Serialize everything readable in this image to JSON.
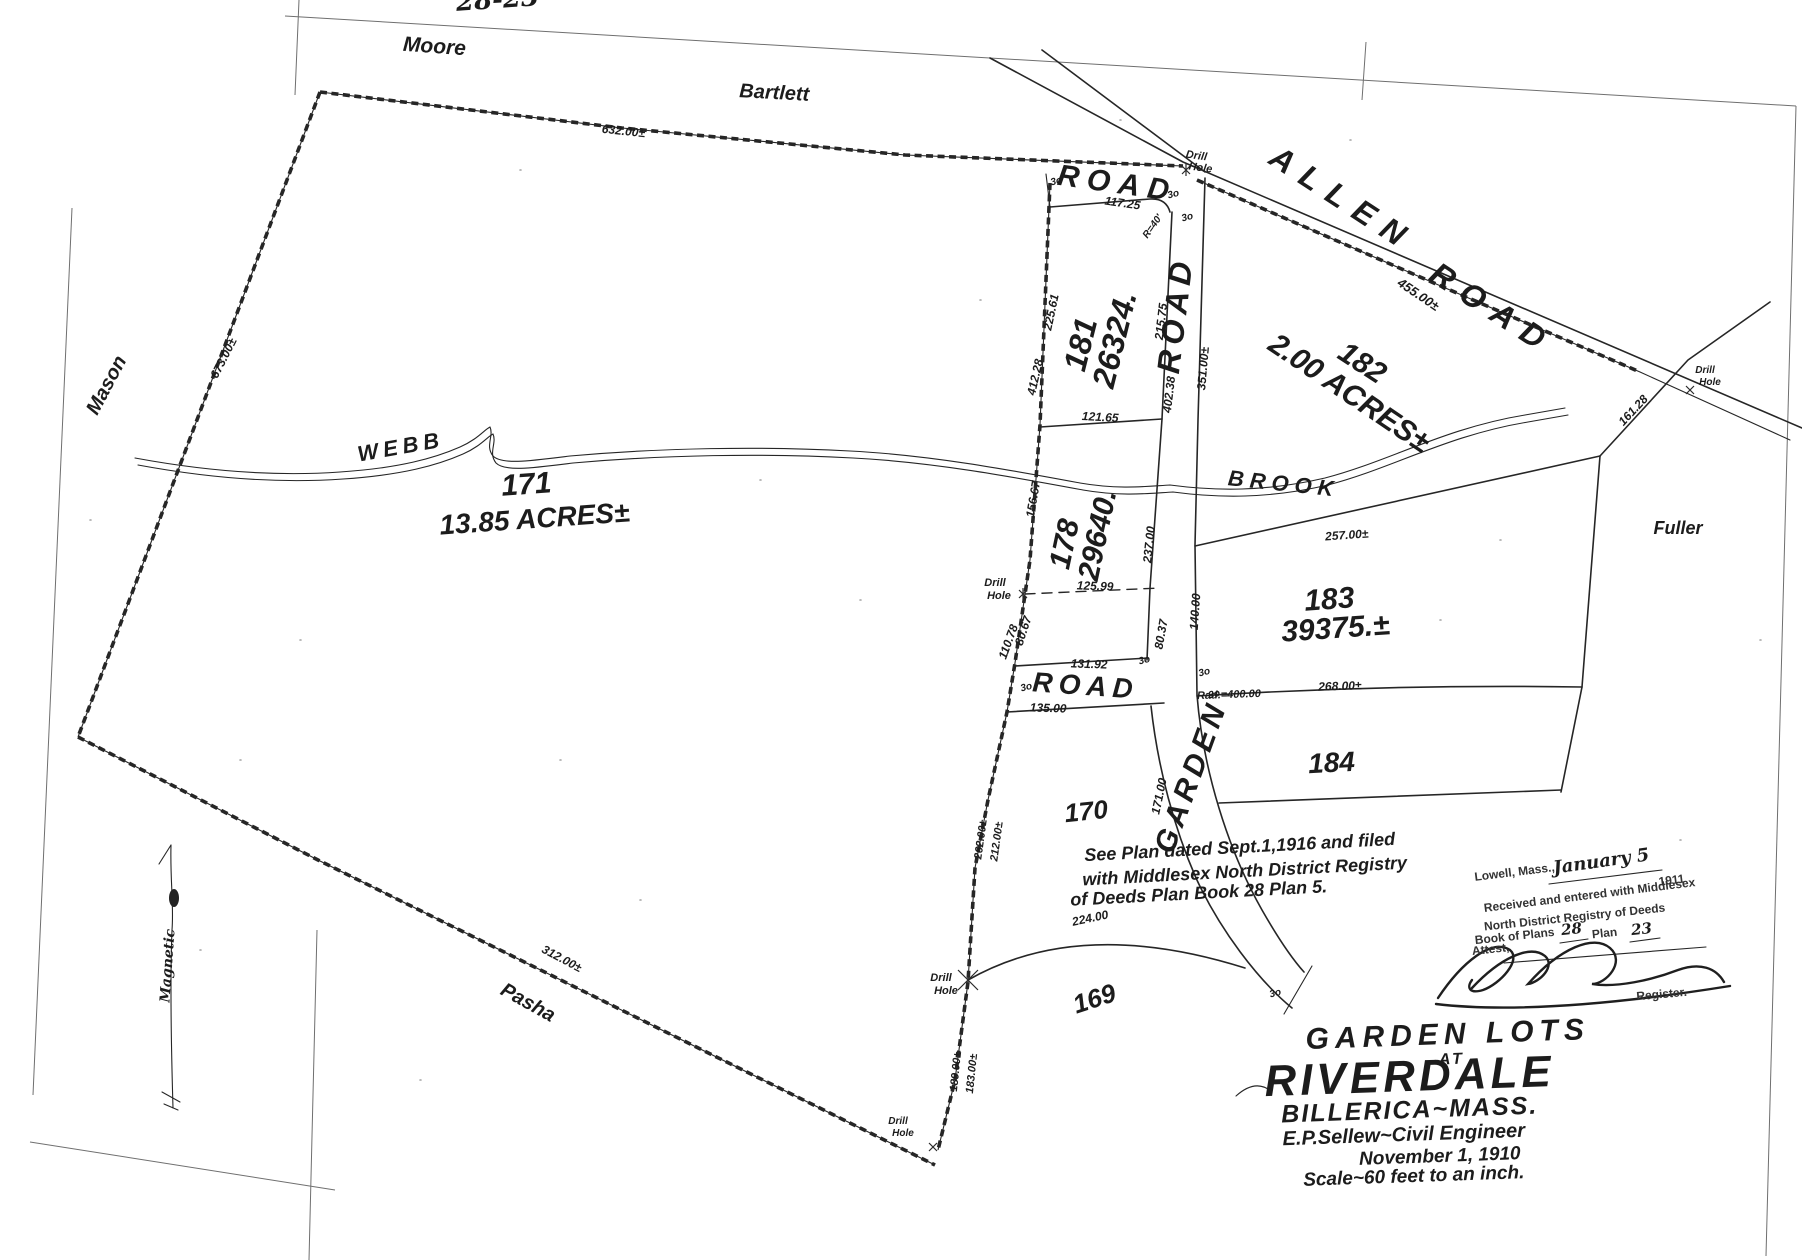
{
  "summary": {
    "plan_title": "Garden Lots at Riverdale, Billerica, Mass.",
    "engineer": "E.P.Sellew~Civil Engineer",
    "date": "November 1, 1910",
    "scale": "Scale~60 feet to an inch.",
    "lots": [
      {
        "number": "171",
        "area": "13.85 ACRES±"
      },
      {
        "number": "181",
        "area": "26324."
      },
      {
        "number": "182",
        "area": "2.00 ACRES±"
      },
      {
        "number": "178",
        "area": "29640."
      },
      {
        "number": "183",
        "area": "39375.±"
      },
      {
        "number": "184",
        "area": ""
      },
      {
        "number": "170",
        "area": ""
      },
      {
        "number": "169",
        "area": ""
      }
    ],
    "roads": [
      "ALLEN ROAD",
      "GARDEN ROAD",
      "ROAD"
    ],
    "abutters": [
      "Moore",
      "Bartlett",
      "Mason",
      "Pasha",
      "Fuller"
    ],
    "watercourse": "WEBB BROOK",
    "page_ref": "28-23"
  },
  "labels": [
    {
      "n": "page-ref",
      "t": "28-23",
      "x": 498,
      "y": 8,
      "r": -4,
      "s": 26,
      "c": "cursive"
    },
    {
      "n": "road-label-bartlett-segment",
      "t": "ROAD",
      "x": 1116,
      "y": 193,
      "r": 8,
      "s": 30,
      "sp": 8,
      "c": "hand"
    },
    {
      "n": "allen-road-label-allen",
      "t": "ALLEN",
      "x": 1337,
      "y": 208,
      "r": 33,
      "s": 32,
      "sp": 12,
      "c": "hand"
    },
    {
      "n": "allen-road-label-road",
      "t": "ROAD",
      "x": 1487,
      "y": 318,
      "r": 33,
      "s": 32,
      "sp": 12,
      "c": "hand"
    },
    {
      "n": "garden-road-label-road",
      "t": "ROAD",
      "x": 1186,
      "y": 316,
      "r": -83,
      "s": 32,
      "sp": 6,
      "c": "hand"
    },
    {
      "n": "garden-road-label-garden",
      "t": "GARDEN",
      "x": 1200,
      "y": 780,
      "r": -70,
      "s": 30,
      "sp": 5,
      "c": "hand"
    },
    {
      "n": "access-road-label",
      "t": "ROAD",
      "x": 1085,
      "y": 695,
      "r": 4,
      "s": 28,
      "sp": 6,
      "c": "hand"
    },
    {
      "n": "abutter-moore",
      "t": "Moore",
      "x": 434,
      "y": 53,
      "r": 4,
      "s": 21,
      "c": "hand"
    },
    {
      "n": "abutter-bartlett",
      "t": "Bartlett",
      "x": 774,
      "y": 99,
      "r": 3,
      "s": 20,
      "c": "hand"
    },
    {
      "n": "abutter-mason",
      "t": "Mason",
      "x": 112,
      "y": 388,
      "r": -62,
      "s": 20,
      "c": "hand"
    },
    {
      "n": "abutter-pasha",
      "t": "Pasha",
      "x": 525,
      "y": 1008,
      "r": 29,
      "s": 20,
      "c": "hand"
    },
    {
      "n": "abutter-fuller",
      "t": "Fuller",
      "x": 1678,
      "y": 534,
      "r": 0,
      "s": 18,
      "c": "hand"
    },
    {
      "n": "webb-brook-label-webb",
      "t": "WEBB",
      "x": 402,
      "y": 454,
      "r": -10,
      "s": 22,
      "sp": 5,
      "c": "hand"
    },
    {
      "n": "webb-brook-label-brook",
      "t": "BROOK",
      "x": 1283,
      "y": 491,
      "r": 6,
      "s": 22,
      "sp": 6,
      "c": "hand"
    },
    {
      "n": "magnetic-north-label",
      "t": "Magnetic",
      "x": 172,
      "y": 966,
      "r": -86,
      "s": 14,
      "c": "cursive"
    },
    {
      "n": "lot-171-number",
      "t": "171",
      "x": 527,
      "y": 494,
      "r": -4,
      "s": 30,
      "c": "hand"
    },
    {
      "n": "lot-171-area",
      "t": "13.85 ACRES±",
      "x": 535,
      "y": 528,
      "r": -4,
      "s": 28,
      "c": "hand"
    },
    {
      "n": "lot-181-number",
      "t": "181",
      "x": 1091,
      "y": 347,
      "r": -76,
      "s": 32,
      "c": "hand"
    },
    {
      "n": "lot-181-area",
      "t": "26324.",
      "x": 1125,
      "y": 342,
      "r": -76,
      "s": 32,
      "c": "hand"
    },
    {
      "n": "lot-182-number",
      "t": "182",
      "x": 1357,
      "y": 371,
      "r": 33,
      "s": 30,
      "c": "hand"
    },
    {
      "n": "lot-182-area",
      "t": "2.00 ACRES±",
      "x": 1344,
      "y": 401,
      "r": 34,
      "s": 30,
      "c": "hand"
    },
    {
      "n": "lot-178-number",
      "t": "178",
      "x": 1074,
      "y": 546,
      "r": -78,
      "s": 30,
      "c": "hand"
    },
    {
      "n": "lot-178-area",
      "t": "29640.",
      "x": 1107,
      "y": 537,
      "r": -78,
      "s": 30,
      "c": "hand"
    },
    {
      "n": "lot-183-number",
      "t": "183",
      "x": 1330,
      "y": 609,
      "r": -4,
      "s": 30,
      "c": "hand"
    },
    {
      "n": "lot-183-area",
      "t": "39375.±",
      "x": 1336,
      "y": 638,
      "r": -4,
      "s": 30,
      "c": "hand"
    },
    {
      "n": "lot-184-number",
      "t": "184",
      "x": 1332,
      "y": 772,
      "r": -3,
      "s": 28,
      "c": "hand"
    },
    {
      "n": "lot-170-number",
      "t": "170",
      "x": 1087,
      "y": 820,
      "r": -6,
      "s": 26,
      "c": "hand"
    },
    {
      "n": "lot-169-number",
      "t": "169",
      "x": 1097,
      "y": 1007,
      "r": -18,
      "s": 26,
      "c": "hand"
    },
    {
      "n": "dim-632",
      "t": "632.00±",
      "x": 623,
      "y": 135,
      "r": 6,
      "s": 12,
      "c": "hand"
    },
    {
      "n": "dim-673",
      "t": "673.00±",
      "x": 227,
      "y": 360,
      "r": -63,
      "s": 12,
      "c": "hand"
    },
    {
      "n": "dim-455",
      "t": "455.00±",
      "x": 1416,
      "y": 298,
      "r": 34,
      "s": 13,
      "c": "hand"
    },
    {
      "n": "dim-117-25",
      "t": "117.25",
      "x": 1122,
      "y": 207,
      "r": 8,
      "s": 12,
      "c": "hand"
    },
    {
      "n": "dim-225-61",
      "t": "225.61",
      "x": 1055,
      "y": 313,
      "r": -78,
      "s": 12,
      "c": "hand"
    },
    {
      "n": "dim-412-28",
      "t": "412.28",
      "x": 1039,
      "y": 378,
      "r": -77,
      "s": 12,
      "c": "hand"
    },
    {
      "n": "dim-215-75",
      "t": "215.75",
      "x": 1165,
      "y": 322,
      "r": -83,
      "s": 12,
      "c": "hand"
    },
    {
      "n": "dim-402-38",
      "t": "402.38",
      "x": 1173,
      "y": 395,
      "r": -83,
      "s": 12,
      "c": "hand"
    },
    {
      "n": "dim-351",
      "t": "351.00±",
      "x": 1207,
      "y": 369,
      "r": -85,
      "s": 12,
      "c": "hand"
    },
    {
      "n": "dim-121-65",
      "t": "121.65",
      "x": 1100,
      "y": 421,
      "r": 3,
      "s": 12,
      "c": "hand"
    },
    {
      "n": "dim-156-67",
      "t": "156.67",
      "x": 1037,
      "y": 500,
      "r": -80,
      "s": 12,
      "c": "hand"
    },
    {
      "n": "dim-237",
      "t": "237.00",
      "x": 1153,
      "y": 545,
      "r": -84,
      "s": 12,
      "c": "hand"
    },
    {
      "n": "dim-125-99",
      "t": "125.99",
      "x": 1095,
      "y": 590,
      "r": 2,
      "s": 12,
      "c": "hand"
    },
    {
      "n": "dim-110-78",
      "t": "110.78",
      "x": 1012,
      "y": 643,
      "r": -70,
      "s": 12,
      "c": "hand"
    },
    {
      "n": "dim-80-67",
      "t": "80.67",
      "x": 1027,
      "y": 632,
      "r": -72,
      "s": 12,
      "c": "hand"
    },
    {
      "n": "dim-80-37",
      "t": "80.37",
      "x": 1165,
      "y": 635,
      "r": -80,
      "s": 12,
      "c": "hand"
    },
    {
      "n": "dim-131-92",
      "t": "131.92",
      "x": 1089,
      "y": 668,
      "r": 2,
      "s": 12,
      "c": "hand"
    },
    {
      "n": "dim-135",
      "t": "135.00",
      "x": 1048,
      "y": 712,
      "r": 2,
      "s": 12,
      "c": "hand"
    },
    {
      "n": "dim-257",
      "t": "257.00±",
      "x": 1347,
      "y": 539,
      "r": -4,
      "s": 12,
      "c": "hand"
    },
    {
      "n": "dim-140",
      "t": "140.00",
      "x": 1199,
      "y": 612,
      "r": -86,
      "s": 12,
      "c": "hand"
    },
    {
      "n": "dim-268",
      "t": "268.00±",
      "x": 1340,
      "y": 690,
      "r": -2,
      "s": 12,
      "c": "hand"
    },
    {
      "n": "dim-rad-400",
      "t": "Rad.=400.00",
      "x": 1229,
      "y": 698,
      "r": -2,
      "s": 11,
      "c": "hand"
    },
    {
      "n": "dim-171",
      "t": "171.00",
      "x": 1163,
      "y": 797,
      "r": -78,
      "s": 12,
      "c": "hand"
    },
    {
      "n": "dim-262",
      "t": "262.00±",
      "x": 984,
      "y": 840,
      "r": -82,
      "s": 11,
      "c": "hand"
    },
    {
      "n": "dim-212",
      "t": "212.00±",
      "x": 1000,
      "y": 842,
      "r": -82,
      "s": 11,
      "c": "hand"
    },
    {
      "n": "dim-224",
      "t": "224.00",
      "x": 1091,
      "y": 922,
      "r": -12,
      "s": 12,
      "c": "hand"
    },
    {
      "n": "dim-189",
      "t": "189.00±",
      "x": 959,
      "y": 1072,
      "r": -84,
      "s": 11,
      "c": "hand"
    },
    {
      "n": "dim-183",
      "t": "183.00±",
      "x": 975,
      "y": 1074,
      "r": -84,
      "s": 11,
      "c": "hand"
    },
    {
      "n": "dim-312",
      "t": "312.00±",
      "x": 560,
      "y": 962,
      "r": 28,
      "s": 12,
      "c": "hand"
    },
    {
      "n": "dim-161-28",
      "t": "161.28",
      "x": 1636,
      "y": 413,
      "r": -47,
      "s": 12,
      "c": "hand"
    },
    {
      "n": "dim-r40",
      "t": "R=40'",
      "x": 1155,
      "y": 228,
      "r": -55,
      "s": 10,
      "c": "hand"
    },
    {
      "n": "drill-hole-1-line1",
      "t": "Drill",
      "x": 1196,
      "y": 159,
      "r": 8,
      "s": 11,
      "c": "hand"
    },
    {
      "n": "drill-hole-1-line2",
      "t": "Hole",
      "x": 1200,
      "y": 171,
      "r": 8,
      "s": 11,
      "c": "hand"
    },
    {
      "n": "drill-hole-2-line1",
      "t": "Drill",
      "x": 995,
      "y": 586,
      "r": 0,
      "s": 11,
      "c": "hand"
    },
    {
      "n": "drill-hole-2-line2",
      "t": "Hole",
      "x": 999,
      "y": 599,
      "r": 0,
      "s": 11,
      "c": "hand"
    },
    {
      "n": "drill-hole-3-line1",
      "t": "Drill",
      "x": 941,
      "y": 981,
      "r": 0,
      "s": 11,
      "c": "hand"
    },
    {
      "n": "drill-hole-3-line2",
      "t": "Hole",
      "x": 946,
      "y": 994,
      "r": 0,
      "s": 11,
      "c": "hand"
    },
    {
      "n": "drill-hole-4-line1",
      "t": "Drill",
      "x": 1705,
      "y": 373,
      "r": 0,
      "s": 10,
      "c": "hand"
    },
    {
      "n": "drill-hole-4-line2",
      "t": "Hole",
      "x": 1710,
      "y": 385,
      "r": 0,
      "s": 10,
      "c": "hand"
    },
    {
      "n": "drill-hole-5-line1",
      "t": "Drill",
      "x": 898,
      "y": 1124,
      "r": 0,
      "s": 10,
      "c": "hand"
    },
    {
      "n": "drill-hole-5-line2",
      "t": "Hole",
      "x": 903,
      "y": 1136,
      "r": 0,
      "s": 10,
      "c": "hand"
    },
    {
      "n": "road-width-mark-1",
      "t": "3o",
      "x": 1057,
      "y": 184,
      "r": -15,
      "s": 10,
      "c": "hand"
    },
    {
      "n": "road-width-mark-2",
      "t": "3o",
      "x": 1174,
      "y": 197,
      "r": -15,
      "s": 10,
      "c": "hand"
    },
    {
      "n": "road-width-mark-3",
      "t": "3o",
      "x": 1188,
      "y": 220,
      "r": -15,
      "s": 10,
      "c": "hand"
    },
    {
      "n": "road-width-mark-4",
      "t": "3o",
      "x": 1027,
      "y": 690,
      "r": -15,
      "s": 10,
      "c": "hand"
    },
    {
      "n": "road-width-mark-5",
      "t": "3o",
      "x": 1145,
      "y": 663,
      "r": -15,
      "s": 10,
      "c": "hand"
    },
    {
      "n": "road-width-mark-6",
      "t": "3o",
      "x": 1205,
      "y": 675,
      "r": -15,
      "s": 10,
      "c": "hand"
    },
    {
      "n": "road-width-mark-7",
      "t": "3o",
      "x": 1215,
      "y": 697,
      "r": -15,
      "s": 10,
      "c": "hand"
    },
    {
      "n": "road-width-mark-8",
      "t": "3o",
      "x": 1276,
      "y": 996,
      "r": -15,
      "s": 10,
      "c": "hand"
    },
    {
      "n": "plan-note-line1",
      "t": "See Plan dated Sept.1,1916 and filed",
      "x": 1240,
      "y": 853,
      "r": -3,
      "s": 18,
      "c": "hand"
    },
    {
      "n": "plan-note-line2",
      "t": "with Middlesex North District Registry",
      "x": 1245,
      "y": 877,
      "r": -3,
      "s": 18,
      "c": "hand"
    },
    {
      "n": "plan-note-line3",
      "t": "of Deeds Plan Book 28 Plan 5.",
      "x": 1199,
      "y": 899,
      "r": -3,
      "s": 18,
      "c": "hand"
    },
    {
      "n": "title-line1",
      "t": "GARDEN LOTS",
      "x": 1448,
      "y": 1044,
      "r": -2,
      "s": 30,
      "sp": 6,
      "c": "title"
    },
    {
      "n": "title-line2",
      "t": "AT",
      "x": 1452,
      "y": 1064,
      "r": -2,
      "s": 16,
      "sp": 3,
      "c": "title"
    },
    {
      "n": "title-line3",
      "t": "RIVERDALE",
      "x": 1410,
      "y": 1091,
      "r": -2,
      "s": 44,
      "sp": 4,
      "c": "title"
    },
    {
      "n": "title-line4",
      "t": "BILLERICA~MASS.",
      "x": 1410,
      "y": 1118,
      "r": -2,
      "s": 25,
      "sp": 2,
      "c": "title"
    },
    {
      "n": "title-line5",
      "t": "E.P.Sellew~Civil Engineer",
      "x": 1404,
      "y": 1141,
      "r": -2,
      "s": 20,
      "c": "title"
    },
    {
      "n": "title-line6",
      "t": "November 1, 1910",
      "x": 1440,
      "y": 1162,
      "r": -2,
      "s": 19,
      "c": "title"
    },
    {
      "n": "title-line7",
      "t": "Scale~60 feet to an inch.",
      "x": 1414,
      "y": 1182,
      "r": -2,
      "s": 19,
      "c": "title"
    },
    {
      "n": "stamp-place",
      "t": "Lowell, Mass.,",
      "x": 1515,
      "y": 876,
      "r": -7,
      "s": 12,
      "c": "stamp"
    },
    {
      "n": "stamp-date-handwritten",
      "t": "January 5",
      "x": 1602,
      "y": 867,
      "r": -8,
      "s": 18,
      "c": "cursive"
    },
    {
      "n": "stamp-year",
      "t": "1911",
      "x": 1672,
      "y": 884,
      "r": -7,
      "s": 12,
      "c": "stamp"
    },
    {
      "n": "stamp-line2",
      "t": "Received and entered with Middlesex",
      "x": 1590,
      "y": 899,
      "r": -7,
      "s": 12,
      "c": "stamp"
    },
    {
      "n": "stamp-line3",
      "t": "North District Registry of Deeds",
      "x": 1575,
      "y": 921,
      "r": -6,
      "s": 12,
      "c": "stamp"
    },
    {
      "n": "stamp-book-label",
      "t": "Book of Plans",
      "x": 1515,
      "y": 940,
      "r": -6,
      "s": 12,
      "c": "stamp"
    },
    {
      "n": "stamp-book-number",
      "t": "28",
      "x": 1572,
      "y": 934,
      "r": -6,
      "s": 15,
      "c": "cursive"
    },
    {
      "n": "stamp-plan-label",
      "t": "Plan",
      "x": 1605,
      "y": 937,
      "r": -6,
      "s": 12,
      "c": "stamp"
    },
    {
      "n": "stamp-plan-number",
      "t": "23",
      "x": 1642,
      "y": 934,
      "r": -6,
      "s": 15,
      "c": "cursive"
    },
    {
      "n": "stamp-attest",
      "t": "Attest,",
      "x": 1491,
      "y": 953,
      "r": -6,
      "s": 12,
      "c": "stamp"
    },
    {
      "n": "stamp-register",
      "t": "Register.",
      "x": 1662,
      "y": 998,
      "r": -5,
      "s": 12,
      "c": "stamp"
    }
  ]
}
